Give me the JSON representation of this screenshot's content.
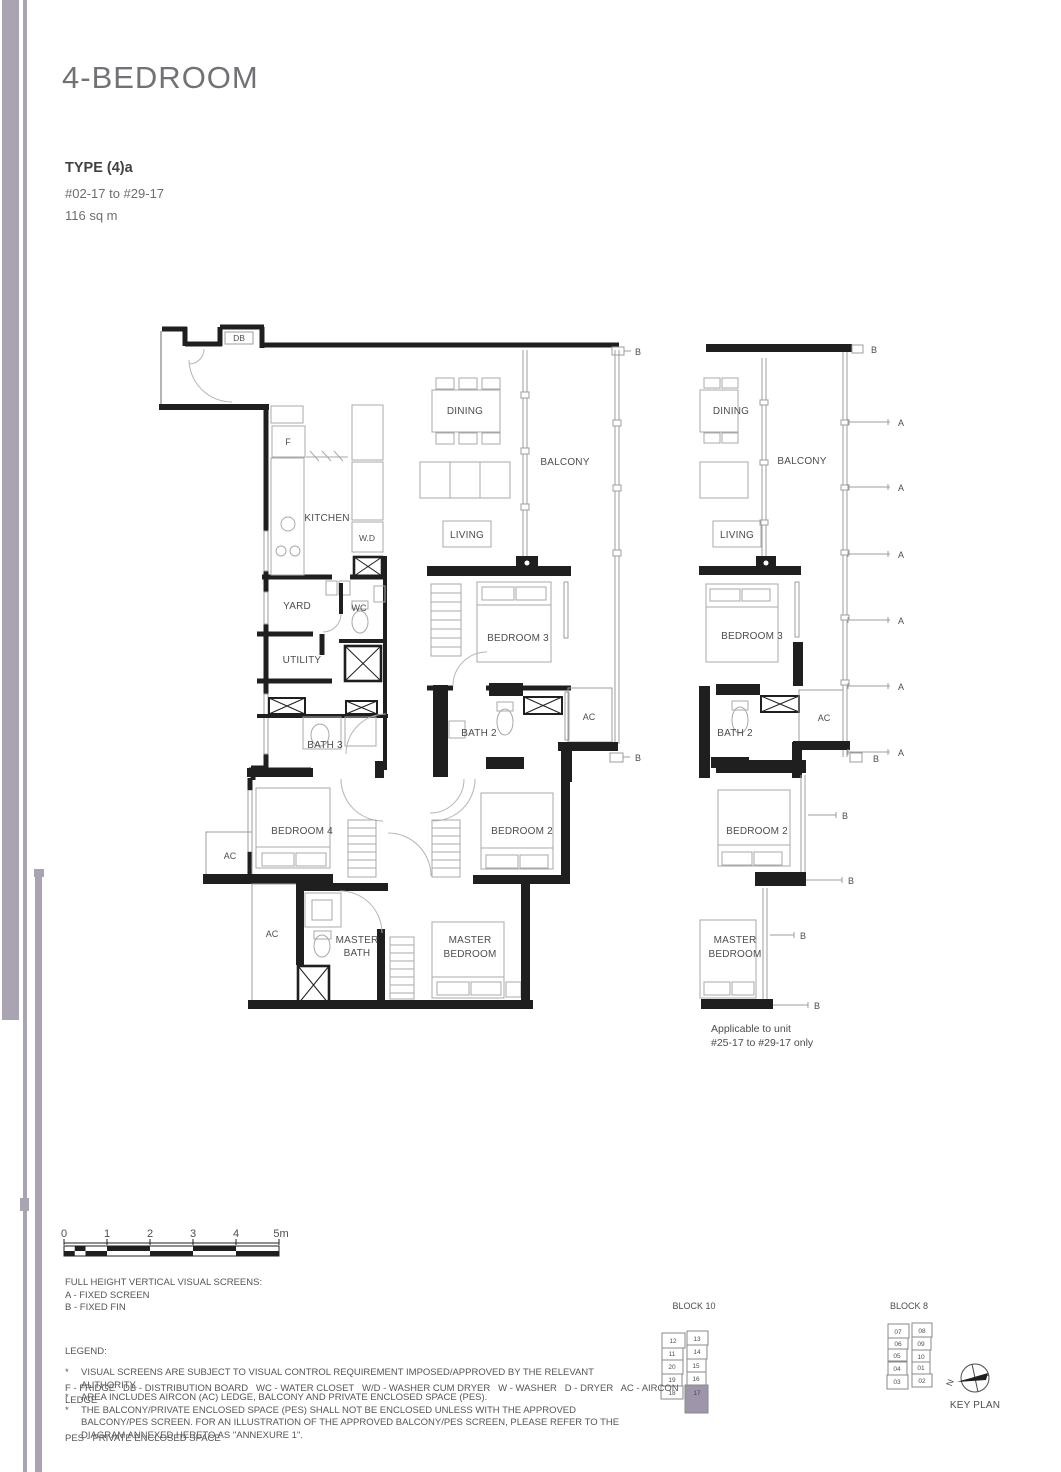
{
  "header": {
    "title": "4-BEDROOM",
    "type": "TYPE (4)a",
    "units": "#02-17 to #29-17",
    "area": "116 sq m"
  },
  "plan": {
    "labels": {
      "db": "DB",
      "fridge": "F",
      "kitchen": "KITCHEN",
      "wd": "W.D",
      "dining": "DINING",
      "balcony": "BALCONY",
      "living": "LIVING",
      "yard": "YARD",
      "wc": "WC",
      "utility": "UTILITY",
      "bath3": "BATH 3",
      "bedroom3": "BEDROOM 3",
      "bath2": "BATH 2",
      "ac": "AC",
      "bedroom4": "BEDROOM 4",
      "bedroom2": "BEDROOM 2",
      "master": "MASTER",
      "bath": "BATH",
      "bedroom": "BEDROOM"
    },
    "markers": {
      "a": "A",
      "b": "B"
    }
  },
  "variant": {
    "note1": "Applicable to unit",
    "note2": "#25-17 to #29-17 only"
  },
  "scale": {
    "ticks": [
      "0",
      "1",
      "2",
      "3",
      "4",
      "5m"
    ]
  },
  "footer": {
    "screens_title": "FULL HEIGHT VERTICAL VISUAL SCREENS:",
    "screen_a": "A - FIXED SCREEN",
    "screen_b": "B - FIXED FIN",
    "legend_title": "LEGEND:",
    "legend_line1": "F - FRIDGE   DB - DISTRIBUTION BOARD   WC - WATER CLOSET   W/D - WASHER CUM DRYER   W - WASHER   D - DRYER   AC - AIRCON LEDGE",
    "legend_line2": "PES - PRIVATE ENCLOSED SPACE",
    "marker": "*",
    "notes": [
      "VISUAL SCREENS ARE SUBJECT TO VISUAL CONTROL REQUIREMENT IMPOSED/APPROVED BY THE RELEVANT AUTHORITY.",
      "AREA INCLUDES AIRCON (AC) LEDGE, BALCONY AND PRIVATE ENCLOSED SPACE (PES).",
      "THE BALCONY/PRIVATE ENCLOSED SPACE (PES) SHALL NOT BE ENCLOSED UNLESS WITH THE APPROVED BALCONY/PES SCREEN. FOR AN ILLUSTRATION OF THE APPROVED BALCONY/PES SCREEN, PLEASE REFER TO THE DIAGRAM ANNEXED HERETO AS \"ANNEXURE 1\"."
    ]
  },
  "keyplan": {
    "block10": {
      "title": "BLOCK 10",
      "units": [
        "12",
        "13",
        "11",
        "14",
        "20",
        "15",
        "19",
        "16",
        "18",
        "17"
      ],
      "highlight": "17"
    },
    "block8": {
      "title": "BLOCK 8",
      "units": [
        "07",
        "08",
        "06",
        "09",
        "05",
        "10",
        "04",
        "01",
        "03",
        "02"
      ]
    },
    "caption": "KEY PLAN",
    "north": "N"
  },
  "colors": {
    "accent": "#a9a3b2",
    "highlight": "#9e95aa",
    "ink": "#4c4d4f",
    "wall": "#1f1f1f"
  }
}
